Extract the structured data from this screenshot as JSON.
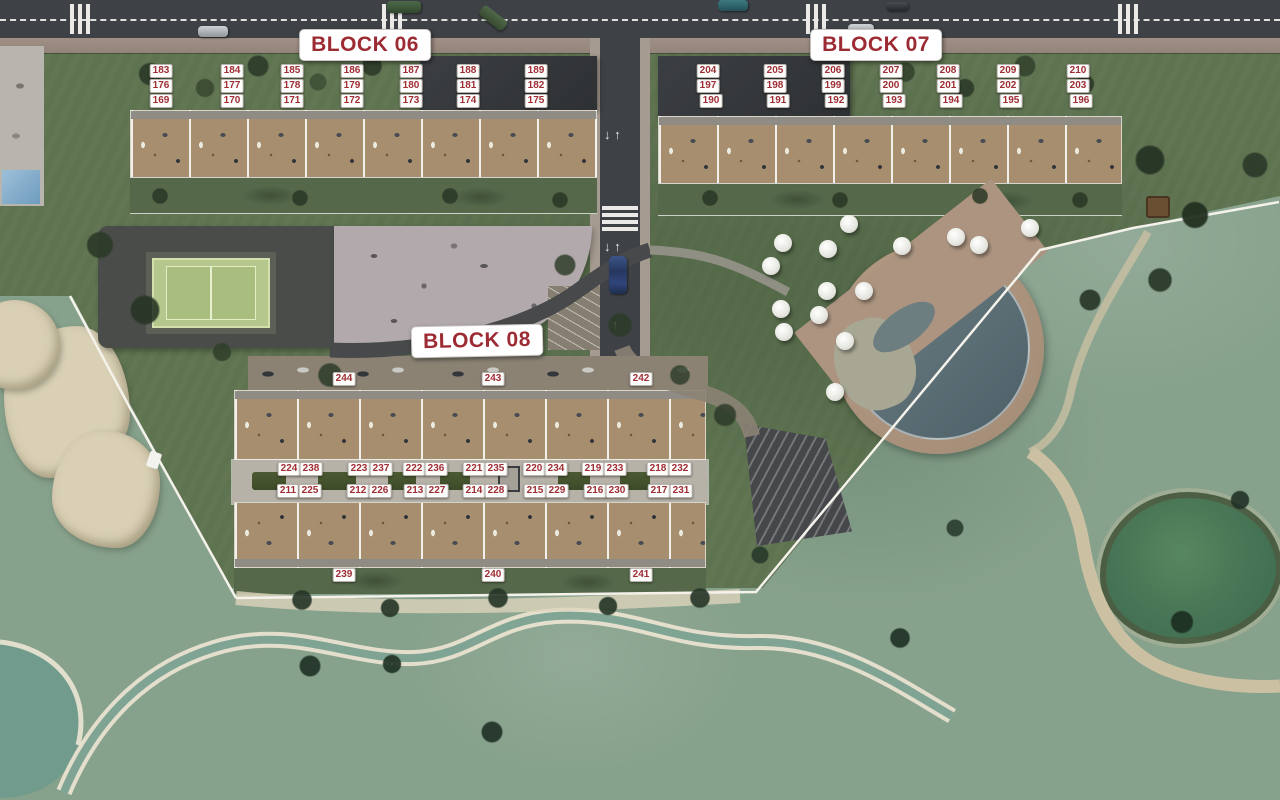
{
  "plan": {
    "type": "residential-masterplan-aerial",
    "blocks": [
      {
        "id": "block-06",
        "label": "BLOCK 06",
        "label_pos": {
          "x": 365,
          "y": 45
        },
        "units": [
          {
            "n": "183",
            "x": 161,
            "y": 71
          },
          {
            "n": "184",
            "x": 232,
            "y": 71
          },
          {
            "n": "185",
            "x": 292,
            "y": 71
          },
          {
            "n": "186",
            "x": 352,
            "y": 71
          },
          {
            "n": "187",
            "x": 411,
            "y": 71
          },
          {
            "n": "188",
            "x": 468,
            "y": 71
          },
          {
            "n": "189",
            "x": 536,
            "y": 71
          },
          {
            "n": "176",
            "x": 161,
            "y": 86
          },
          {
            "n": "177",
            "x": 232,
            "y": 86
          },
          {
            "n": "178",
            "x": 292,
            "y": 86
          },
          {
            "n": "179",
            "x": 352,
            "y": 86
          },
          {
            "n": "180",
            "x": 411,
            "y": 86
          },
          {
            "n": "181",
            "x": 468,
            "y": 86
          },
          {
            "n": "182",
            "x": 536,
            "y": 86
          },
          {
            "n": "169",
            "x": 161,
            "y": 101
          },
          {
            "n": "170",
            "x": 232,
            "y": 101
          },
          {
            "n": "171",
            "x": 292,
            "y": 101
          },
          {
            "n": "172",
            "x": 352,
            "y": 101
          },
          {
            "n": "173",
            "x": 411,
            "y": 101
          },
          {
            "n": "174",
            "x": 468,
            "y": 101
          },
          {
            "n": "175",
            "x": 536,
            "y": 101
          }
        ]
      },
      {
        "id": "block-07",
        "label": "BLOCK 07",
        "label_pos": {
          "x": 876,
          "y": 45
        },
        "units": [
          {
            "n": "204",
            "x": 708,
            "y": 71
          },
          {
            "n": "205",
            "x": 775,
            "y": 71
          },
          {
            "n": "206",
            "x": 833,
            "y": 71
          },
          {
            "n": "207",
            "x": 891,
            "y": 71
          },
          {
            "n": "208",
            "x": 948,
            "y": 71
          },
          {
            "n": "209",
            "x": 1008,
            "y": 71
          },
          {
            "n": "210",
            "x": 1078,
            "y": 71
          },
          {
            "n": "197",
            "x": 708,
            "y": 86
          },
          {
            "n": "198",
            "x": 775,
            "y": 86
          },
          {
            "n": "199",
            "x": 833,
            "y": 86
          },
          {
            "n": "200",
            "x": 891,
            "y": 86
          },
          {
            "n": "201",
            "x": 948,
            "y": 86
          },
          {
            "n": "202",
            "x": 1008,
            "y": 86
          },
          {
            "n": "203",
            "x": 1078,
            "y": 86
          },
          {
            "n": "190",
            "x": 711,
            "y": 101
          },
          {
            "n": "191",
            "x": 778,
            "y": 101
          },
          {
            "n": "192",
            "x": 836,
            "y": 101
          },
          {
            "n": "193",
            "x": 894,
            "y": 101
          },
          {
            "n": "194",
            "x": 951,
            "y": 101
          },
          {
            "n": "195",
            "x": 1011,
            "y": 101
          },
          {
            "n": "196",
            "x": 1081,
            "y": 101
          }
        ]
      },
      {
        "id": "block-08",
        "label": "BLOCK 08",
        "label_pos": {
          "x": 477,
          "y": 341
        },
        "units": [
          {
            "n": "244",
            "x": 344,
            "y": 379
          },
          {
            "n": "243",
            "x": 493,
            "y": 379
          },
          {
            "n": "242",
            "x": 641,
            "y": 379
          },
          {
            "n": "224",
            "x": 289,
            "y": 469
          },
          {
            "n": "238",
            "x": 311,
            "y": 469
          },
          {
            "n": "223",
            "x": 359,
            "y": 469
          },
          {
            "n": "237",
            "x": 381,
            "y": 469
          },
          {
            "n": "222",
            "x": 414,
            "y": 469
          },
          {
            "n": "236",
            "x": 436,
            "y": 469
          },
          {
            "n": "221",
            "x": 474,
            "y": 469
          },
          {
            "n": "235",
            "x": 496,
            "y": 469
          },
          {
            "n": "220",
            "x": 534,
            "y": 469
          },
          {
            "n": "234",
            "x": 556,
            "y": 469
          },
          {
            "n": "219",
            "x": 593,
            "y": 469
          },
          {
            "n": "233",
            "x": 615,
            "y": 469
          },
          {
            "n": "218",
            "x": 658,
            "y": 469
          },
          {
            "n": "232",
            "x": 680,
            "y": 469
          },
          {
            "n": "211",
            "x": 288,
            "y": 491
          },
          {
            "n": "225",
            "x": 310,
            "y": 491
          },
          {
            "n": "212",
            "x": 358,
            "y": 491
          },
          {
            "n": "226",
            "x": 380,
            "y": 491
          },
          {
            "n": "213",
            "x": 415,
            "y": 491
          },
          {
            "n": "227",
            "x": 437,
            "y": 491
          },
          {
            "n": "214",
            "x": 474,
            "y": 491
          },
          {
            "n": "228",
            "x": 496,
            "y": 491
          },
          {
            "n": "215",
            "x": 535,
            "y": 491
          },
          {
            "n": "229",
            "x": 557,
            "y": 491
          },
          {
            "n": "216",
            "x": 595,
            "y": 491
          },
          {
            "n": "230",
            "x": 617,
            "y": 491
          },
          {
            "n": "217",
            "x": 659,
            "y": 491
          },
          {
            "n": "231",
            "x": 681,
            "y": 491
          },
          {
            "n": "239",
            "x": 344,
            "y": 575
          },
          {
            "n": "240",
            "x": 493,
            "y": 575
          },
          {
            "n": "241",
            "x": 641,
            "y": 575
          }
        ]
      }
    ],
    "colors": {
      "label_text": "#9c2b33",
      "unit_text": "#9e2d34",
      "label_bg": "#ffffff",
      "road_asphalt": "#3e4246",
      "deck_tan": "#a68e6e",
      "development_green": "#5e7350",
      "golf_green": "#86a18c",
      "pool_water": "#54666e",
      "pond_water": "#4b7a5f",
      "court_green": "#b5c78c",
      "sand": "#d9d0b5"
    }
  }
}
